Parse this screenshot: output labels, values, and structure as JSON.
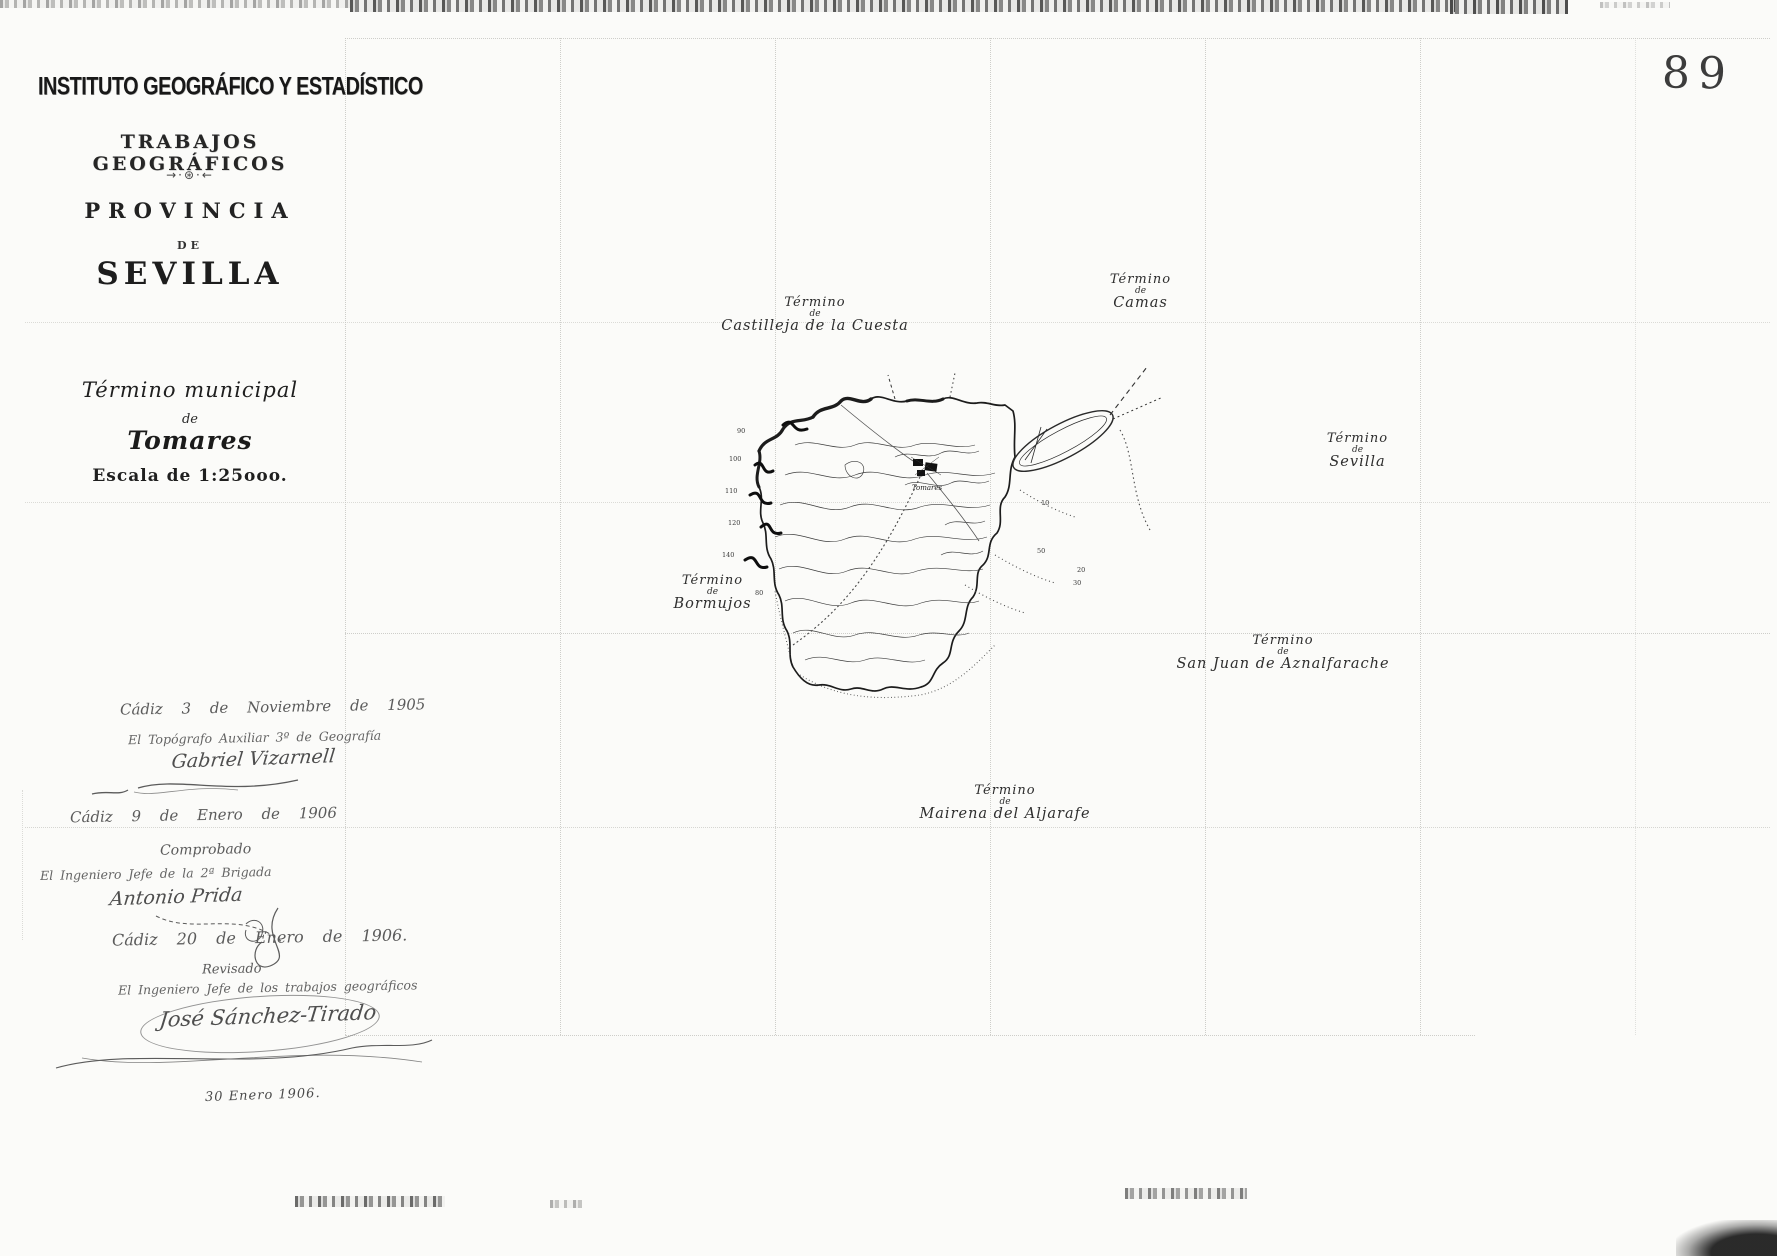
{
  "sheet": {
    "page_number": "89"
  },
  "title_block": {
    "institution": "INSTITUTO GEOGRÁFICO Y ESTADÍSTICO",
    "series": "TRABAJOS GEOGRÁFICOS",
    "ornament": "→·⊛·←",
    "province_label": "PROVINCIA",
    "de_label": "DE",
    "province_name": "SEVILLA",
    "municipality_label_line1": "Término municipal",
    "municipality_label_line2": "de",
    "municipality_name": "Tomares",
    "scale_text": "Escala de 1:25ooo."
  },
  "certifications": [
    {
      "place_date": "Cádiz 3 de Noviembre de 1905",
      "role": "El Topógrafo Auxiliar 3º de Geografía",
      "signature": "Gabriel Vizarnell"
    },
    {
      "place_date": "Cádiz 9 de Enero de 1906",
      "status": "Comprobado",
      "role": "El Ingeniero Jefe de la 2ª Brigada",
      "signature": "Antonio Prida"
    },
    {
      "place_date": "Cádiz 20 de Enero de 1906.",
      "status": "Revisado",
      "role": "El Ingeniero Jefe de los trabajos geográficos",
      "signature": "José Sánchez-Tirado"
    }
  ],
  "margin_note": "30 Enero 1906.",
  "map": {
    "town_label": "Tomares",
    "neighbor_labels": {
      "castilleja": {
        "line1": "Término",
        "line2": "de",
        "line3": "Castilleja de la Cuesta"
      },
      "camas": {
        "line1": "Término",
        "line2": "de",
        "line3": "Camas"
      },
      "sevilla": {
        "line1": "Término",
        "line2": "de",
        "line3": "Sevilla"
      },
      "bormujos": {
        "line1": "Término",
        "line2": "de",
        "line3": "Bormujos"
      },
      "san_juan": {
        "line1": "Término",
        "line2": "de",
        "line3": "San Juan de Aznalfarache"
      },
      "mairena": {
        "line1": "Término",
        "line2": "de",
        "line3": "Mairena del Aljarafe"
      }
    },
    "spot_elevations": [
      "100",
      "110",
      "120",
      "140",
      "90",
      "80",
      "50",
      "30",
      "20",
      "10"
    ]
  }
}
